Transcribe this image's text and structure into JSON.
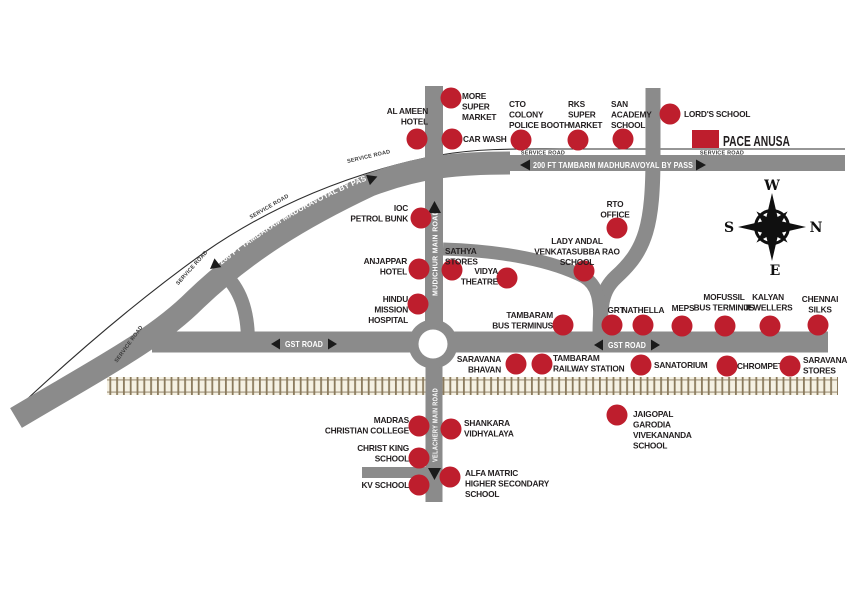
{
  "style": {
    "road_color": "#8b8b8b",
    "dot_color": "#be1e2d",
    "dot_radius": 10.5,
    "label_color": "#231f20",
    "rail_bg": "#f5f1e3",
    "rail_tick": "#8a7a5c",
    "rail_line": "#b0a590"
  },
  "project": {
    "name": "PACE ANUSA",
    "marker": {
      "x": 692,
      "y": 130,
      "w": 27,
      "h": 18
    }
  },
  "roads": {
    "bypass_top": "200 FT TAMBARM MADHURAVOYAL BY PASS",
    "bypass_curve": "200 FT TAMBARAM MADURAVOYAL BY PASS",
    "gst": "GST ROAD",
    "mudichur": "MUDICHUR MAIN ROAD",
    "velachery": "VELACHERY MAIN ROAD",
    "service": "SERVICE ROAD"
  },
  "compass": {
    "top": "W",
    "right": "N",
    "left": "S",
    "bottom": "E"
  },
  "landmarks": [
    {
      "id": "al-ameen-hotel",
      "lines": [
        "AL AMEEN",
        "HOTEL"
      ],
      "dot": {
        "x": 417,
        "y": 139
      },
      "label": {
        "x": 428,
        "y": 114,
        "align": "end"
      }
    },
    {
      "id": "more-super-market",
      "lines": [
        "MORE",
        "SUPER",
        "MARKET"
      ],
      "dot": {
        "x": 451,
        "y": 98
      },
      "label": {
        "x": 462,
        "y": 99,
        "align": "start"
      }
    },
    {
      "id": "car-wash",
      "lines": [
        "CAR WASH"
      ],
      "dot": {
        "x": 452,
        "y": 139
      },
      "label": {
        "x": 463,
        "y": 142,
        "align": "start"
      }
    },
    {
      "id": "cto-colony-police-booth",
      "lines": [
        "CTO",
        "COLONY",
        "POLICE BOOTH"
      ],
      "dot": {
        "x": 521,
        "y": 140
      },
      "label": {
        "x": 509,
        "y": 107,
        "align": "start"
      }
    },
    {
      "id": "rks-super-market",
      "lines": [
        "RKS",
        "SUPER",
        "MARKET"
      ],
      "dot": {
        "x": 578,
        "y": 140
      },
      "label": {
        "x": 568,
        "y": 107,
        "align": "start"
      }
    },
    {
      "id": "san-academy-school",
      "lines": [
        "SAN",
        "ACADEMY",
        "SCHOOL"
      ],
      "dot": {
        "x": 623,
        "y": 139
      },
      "label": {
        "x": 611,
        "y": 107,
        "align": "start"
      }
    },
    {
      "id": "lords-school",
      "lines": [
        "LORD'S SCHOOL"
      ],
      "dot": {
        "x": 670,
        "y": 114
      },
      "label": {
        "x": 684,
        "y": 117,
        "align": "start"
      }
    },
    {
      "id": "ioc-petrol-bunk",
      "lines": [
        "IOC",
        "PETROL BUNK"
      ],
      "dot": {
        "x": 421,
        "y": 218
      },
      "label": {
        "x": 408,
        "y": 211,
        "align": "end"
      }
    },
    {
      "id": "sathya-stores",
      "lines": [
        "SATHYA",
        "STORES"
      ],
      "dot": {
        "x": 452,
        "y": 270
      },
      "label": {
        "x": 445,
        "y": 254,
        "align": "start"
      }
    },
    {
      "id": "anjappar-hotel",
      "lines": [
        "ANJAPPAR",
        "HOTEL"
      ],
      "dot": {
        "x": 419,
        "y": 269
      },
      "label": {
        "x": 407,
        "y": 264,
        "align": "end"
      }
    },
    {
      "id": "vidya-theatre",
      "lines": [
        "VIDYA",
        "THEATRE"
      ],
      "dot": {
        "x": 507,
        "y": 278
      },
      "label": {
        "x": 498,
        "y": 274,
        "align": "end"
      }
    },
    {
      "id": "lady-andal-venkatasubba-rao-school",
      "lines": [
        "LADY ANDAL",
        "VENKATASUBBA RAO",
        "SCHOOL"
      ],
      "dot": {
        "x": 584,
        "y": 271
      },
      "label": {
        "x": 577,
        "y": 244,
        "align": "middle"
      }
    },
    {
      "id": "rto-office",
      "lines": [
        "RTO",
        "OFFICE"
      ],
      "dot": {
        "x": 617,
        "y": 228
      },
      "label": {
        "x": 615,
        "y": 207,
        "align": "middle"
      }
    },
    {
      "id": "hindu-mission-hospital",
      "lines": [
        "HINDU",
        "MISSION",
        "HOSPITAL"
      ],
      "dot": {
        "x": 418,
        "y": 304
      },
      "label": {
        "x": 408,
        "y": 302,
        "align": "end"
      }
    },
    {
      "id": "tambaram-bus-terminus",
      "lines": [
        "TAMBARAM",
        "BUS TERMINUS"
      ],
      "dot": {
        "x": 563,
        "y": 325
      },
      "label": {
        "x": 553,
        "y": 318,
        "align": "end"
      }
    },
    {
      "id": "grt",
      "lines": [
        "GRT"
      ],
      "dot": {
        "x": 612,
        "y": 325
      },
      "label": {
        "x": 616,
        "y": 313,
        "align": "middle"
      }
    },
    {
      "id": "nathella",
      "lines": [
        "NATHELLA"
      ],
      "dot": {
        "x": 643,
        "y": 325
      },
      "label": {
        "x": 643,
        "y": 313,
        "align": "middle"
      }
    },
    {
      "id": "meps",
      "lines": [
        "MEPS"
      ],
      "dot": {
        "x": 682,
        "y": 326
      },
      "label": {
        "x": 683,
        "y": 311,
        "align": "middle"
      }
    },
    {
      "id": "mofussil-bus-terminus",
      "lines": [
        "MOFUSSIL",
        "BUS TERMINUS"
      ],
      "dot": {
        "x": 725,
        "y": 326
      },
      "label": {
        "x": 724,
        "y": 300,
        "align": "middle"
      }
    },
    {
      "id": "kalyan-jewellers",
      "lines": [
        "KALYAN",
        "JEWELLERS"
      ],
      "dot": {
        "x": 770,
        "y": 326
      },
      "label": {
        "x": 768,
        "y": 300,
        "align": "middle"
      }
    },
    {
      "id": "chennai-silks",
      "lines": [
        "CHENNAI",
        "SILKS"
      ],
      "dot": {
        "x": 818,
        "y": 325
      },
      "label": {
        "x": 820,
        "y": 302,
        "align": "middle"
      }
    },
    {
      "id": "saravana-bhavan",
      "lines": [
        "SARAVANA",
        "BHAVAN"
      ],
      "dot": {
        "x": 516,
        "y": 364
      },
      "label": {
        "x": 501,
        "y": 362,
        "align": "end"
      }
    },
    {
      "id": "tambaram-railway-station",
      "lines": [
        "TAMBARAM",
        "RAILWAY STATION"
      ],
      "dot": {
        "x": 542,
        "y": 364
      },
      "label": {
        "x": 553,
        "y": 361,
        "align": "start"
      }
    },
    {
      "id": "sanatorium",
      "lines": [
        "SANATORIUM"
      ],
      "dot": {
        "x": 641,
        "y": 365
      },
      "label": {
        "x": 654,
        "y": 368,
        "align": "start"
      }
    },
    {
      "id": "chrompet",
      "lines": [
        "CHROMPET"
      ],
      "dot": {
        "x": 727,
        "y": 366
      },
      "label": {
        "x": 737,
        "y": 369,
        "align": "start"
      }
    },
    {
      "id": "saravana-stores",
      "lines": [
        "SARAVANA",
        "STORES"
      ],
      "dot": {
        "x": 790,
        "y": 366
      },
      "label": {
        "x": 803,
        "y": 363,
        "align": "start"
      }
    },
    {
      "id": "madras-christian-college",
      "lines": [
        "MADRAS",
        "CHRISTIAN COLLEGE"
      ],
      "dot": {
        "x": 419,
        "y": 426
      },
      "label": {
        "x": 409,
        "y": 423,
        "align": "end"
      }
    },
    {
      "id": "shankara-vidhyalaya",
      "lines": [
        "SHANKARA",
        "VIDHYALAYA"
      ],
      "dot": {
        "x": 451,
        "y": 429
      },
      "label": {
        "x": 464,
        "y": 426,
        "align": "start"
      }
    },
    {
      "id": "christ-king-school",
      "lines": [
        "CHRIST KING",
        "SCHOOL"
      ],
      "dot": {
        "x": 419,
        "y": 458
      },
      "label": {
        "x": 409,
        "y": 451,
        "align": "end"
      }
    },
    {
      "id": "kv-school",
      "lines": [
        "KV SCHOOL"
      ],
      "dot": {
        "x": 419,
        "y": 485
      },
      "label": {
        "x": 409,
        "y": 488,
        "align": "end"
      }
    },
    {
      "id": "alfa-matric-higher-secondary-school",
      "lines": [
        "ALFA MATRIC",
        "HIGHER SECONDARY",
        "SCHOOL"
      ],
      "dot": {
        "x": 450,
        "y": 477
      },
      "label": {
        "x": 465,
        "y": 476,
        "align": "start"
      }
    },
    {
      "id": "jaigopal-garodia-vivekananda-school",
      "lines": [
        "JAIGOPAL",
        "GARODIA",
        "VIVEKANANDA",
        "SCHOOL"
      ],
      "dot": {
        "x": 617,
        "y": 415
      },
      "label": {
        "x": 633,
        "y": 417,
        "align": "start"
      }
    }
  ]
}
